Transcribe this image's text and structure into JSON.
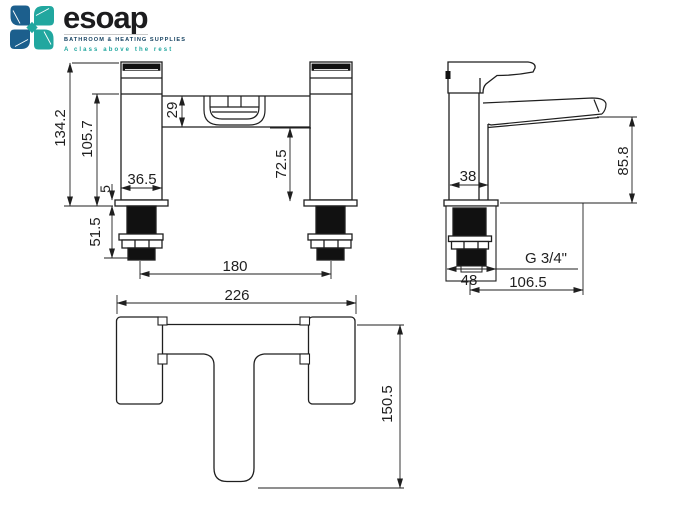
{
  "logo": {
    "brand": "esoap",
    "subtitle": "BATHROOM & HEATING SUPPLIES",
    "tagline": "A class above the rest",
    "teal": "#21a79f",
    "blue": "#1c5f8d"
  },
  "drawing": {
    "front_view": {
      "dims": {
        "overall_height": "134.2",
        "body_height": "105.7",
        "bar_height": "29",
        "body_width": "36.5",
        "base_thickness": "5",
        "under_bar_height": "72.5",
        "thread_length": "51.5",
        "tap_centres": "180",
        "overall_width": "226"
      }
    },
    "side_view": {
      "dims": {
        "body_depth": "38",
        "spout_height": "85.8",
        "thread_spec": "G 3/4\"",
        "tail_width": "48",
        "spout_reach": "106.5"
      }
    },
    "plan_view": {
      "dims": {
        "overall_depth": "150.5"
      }
    }
  }
}
